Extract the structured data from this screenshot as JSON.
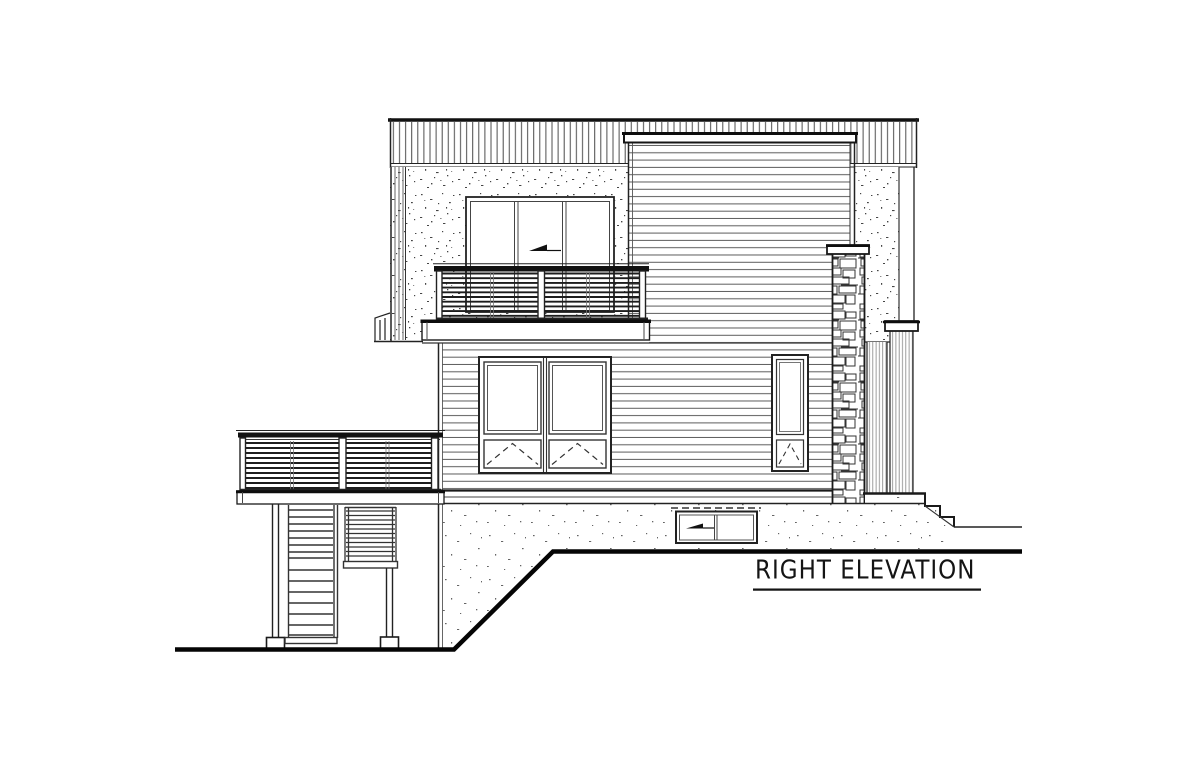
{
  "sheet": {
    "title": {
      "label": "RIGHT ELEVATION",
      "underlined": true
    },
    "drawing_type": "architectural elevation line drawing",
    "view_name": "right elevation"
  },
  "colors": {
    "paper": "#ffffff",
    "ink": "#1a1a1a",
    "siding_line": "#606060",
    "texture_speck": "#454545"
  },
  "annotations": {
    "upper_slider_arrow": "left-pointing slider direction arrow",
    "basement_slider_arrow": "left-pointing slider direction arrow",
    "awning_marks": "dashed V awning operation marks"
  },
  "features": [
    "vertical-sided parapet band",
    "stucco upper wall",
    "three-panel sliding glass door",
    "upper balcony with horizontal slat railing",
    "horizontal lap siding volume",
    "stacked stone chimney",
    "awning windows",
    "vertical-board pilasters",
    "exterior concrete steps",
    "lower deck with slat railing",
    "under-deck stair and screen",
    "basement slider window",
    "sloping grade line"
  ]
}
